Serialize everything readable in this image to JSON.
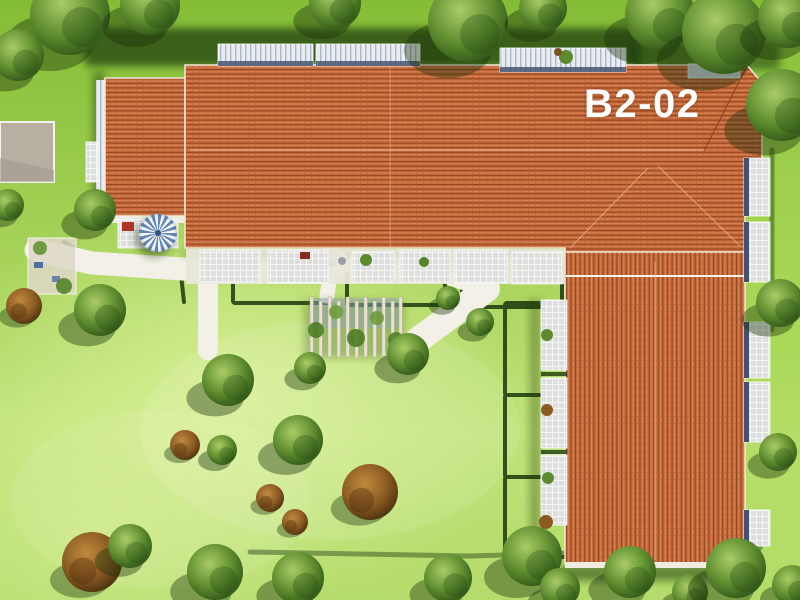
{
  "scene": {
    "building_label": "B2-02",
    "colors": {
      "roof_tile": "#c86c3c",
      "roof_tile_dark": "#93451f",
      "roof_tile_light": "#d98457",
      "lawn_bright": "#bfe278",
      "lawn_green": "#84bd35",
      "walkway": "#f3f1e7",
      "hedge_dark_green": "#1e3d0f",
      "tree_green": "#639132",
      "bush_brown": "#8a5a22",
      "terrace_deck": "#dcdfdd",
      "railing_blue_gray": "#46546e",
      "parasol_blue": "#6287b8",
      "concrete_pad": "#b6afa2",
      "fountain_blue": "#5b7fb0",
      "label_text": "#ffffff"
    }
  }
}
